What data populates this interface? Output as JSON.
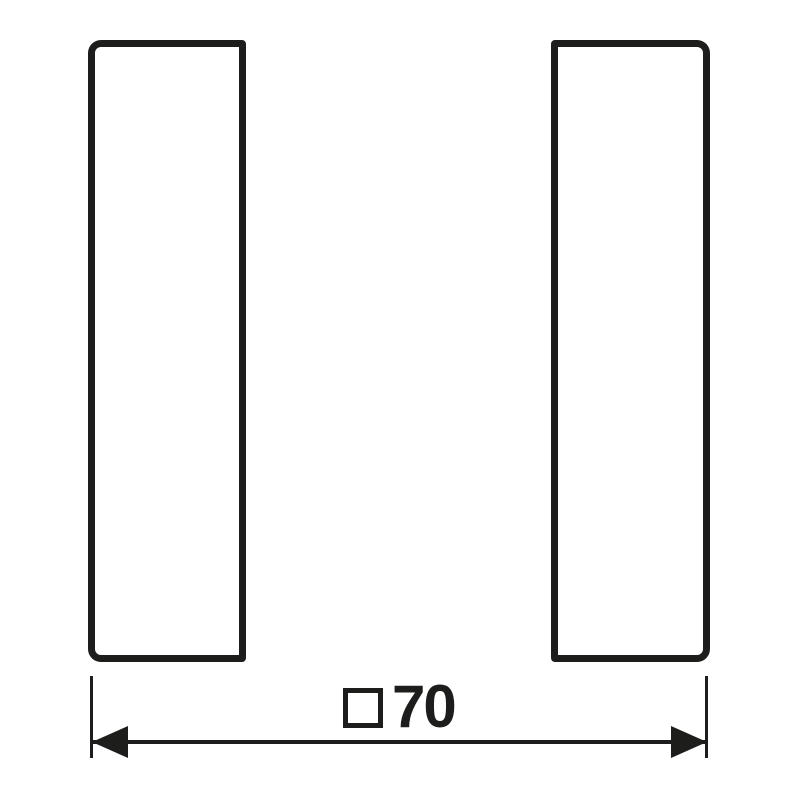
{
  "dimension": {
    "label": "□70",
    "symbol": "□",
    "value": "70"
  },
  "colors": {
    "line": "#1d1d1b",
    "background": "#ffffff"
  }
}
